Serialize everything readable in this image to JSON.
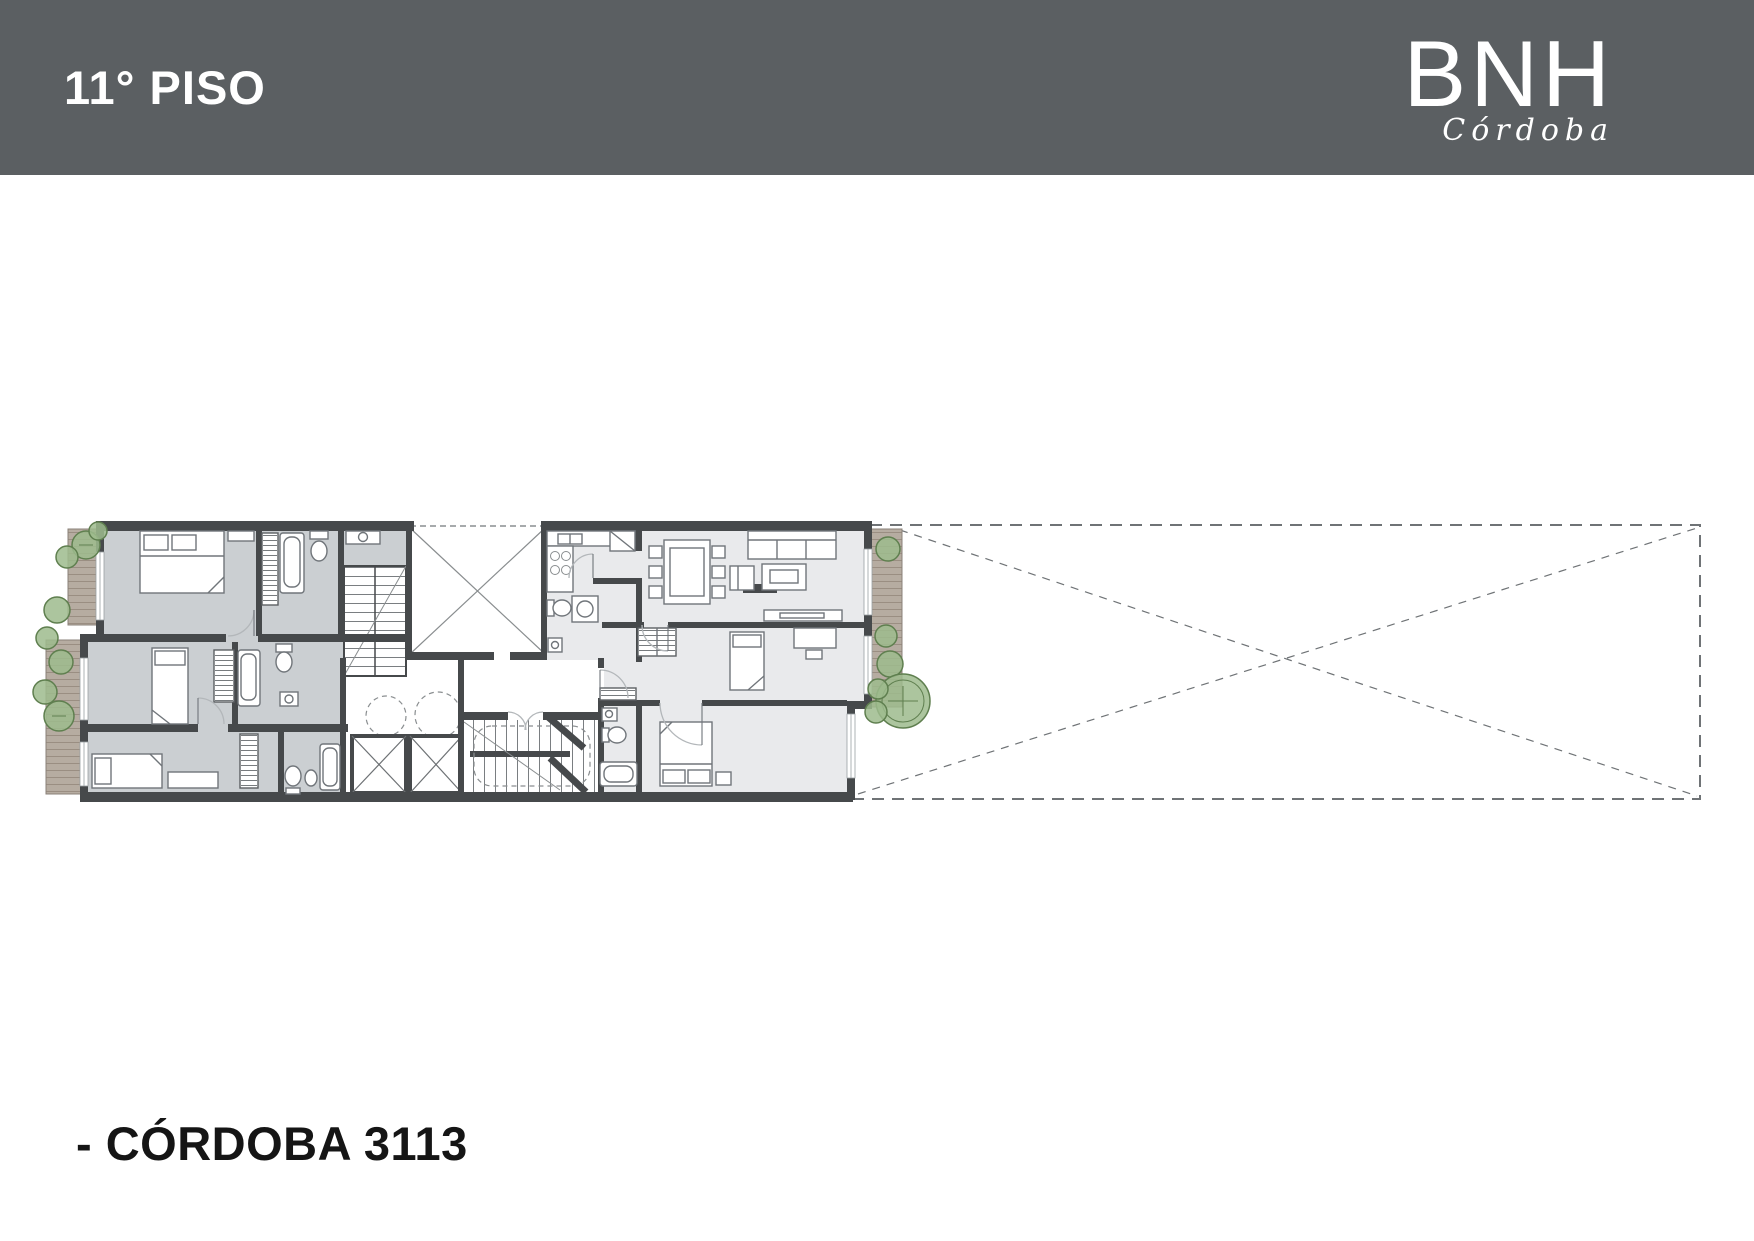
{
  "header": {
    "floor_label": "11° PISO",
    "brand": {
      "name": "BNH",
      "city": "Córdoba"
    }
  },
  "footer": {
    "address": "- CÓRDOBA 3113"
  },
  "plan": {
    "description_icons": [
      "floor-plan-icon",
      "tree-icon",
      "stairs-icon",
      "elevator-icon",
      "bathtub-icon",
      "bed-icon",
      "sofa-icon"
    ]
  },
  "colors": {
    "header_bg": "#5b5f62",
    "wall": "#46494b",
    "floor_left": "#cbcfd2",
    "floor_right": "#e9eaec",
    "deck": "#b6aca1",
    "deck_line": "#9a8e82",
    "tree_fill": "#9dbb8d",
    "tree_stroke": "#5f7f4f",
    "dash": "#6f7376",
    "text_dark": "#151515"
  }
}
